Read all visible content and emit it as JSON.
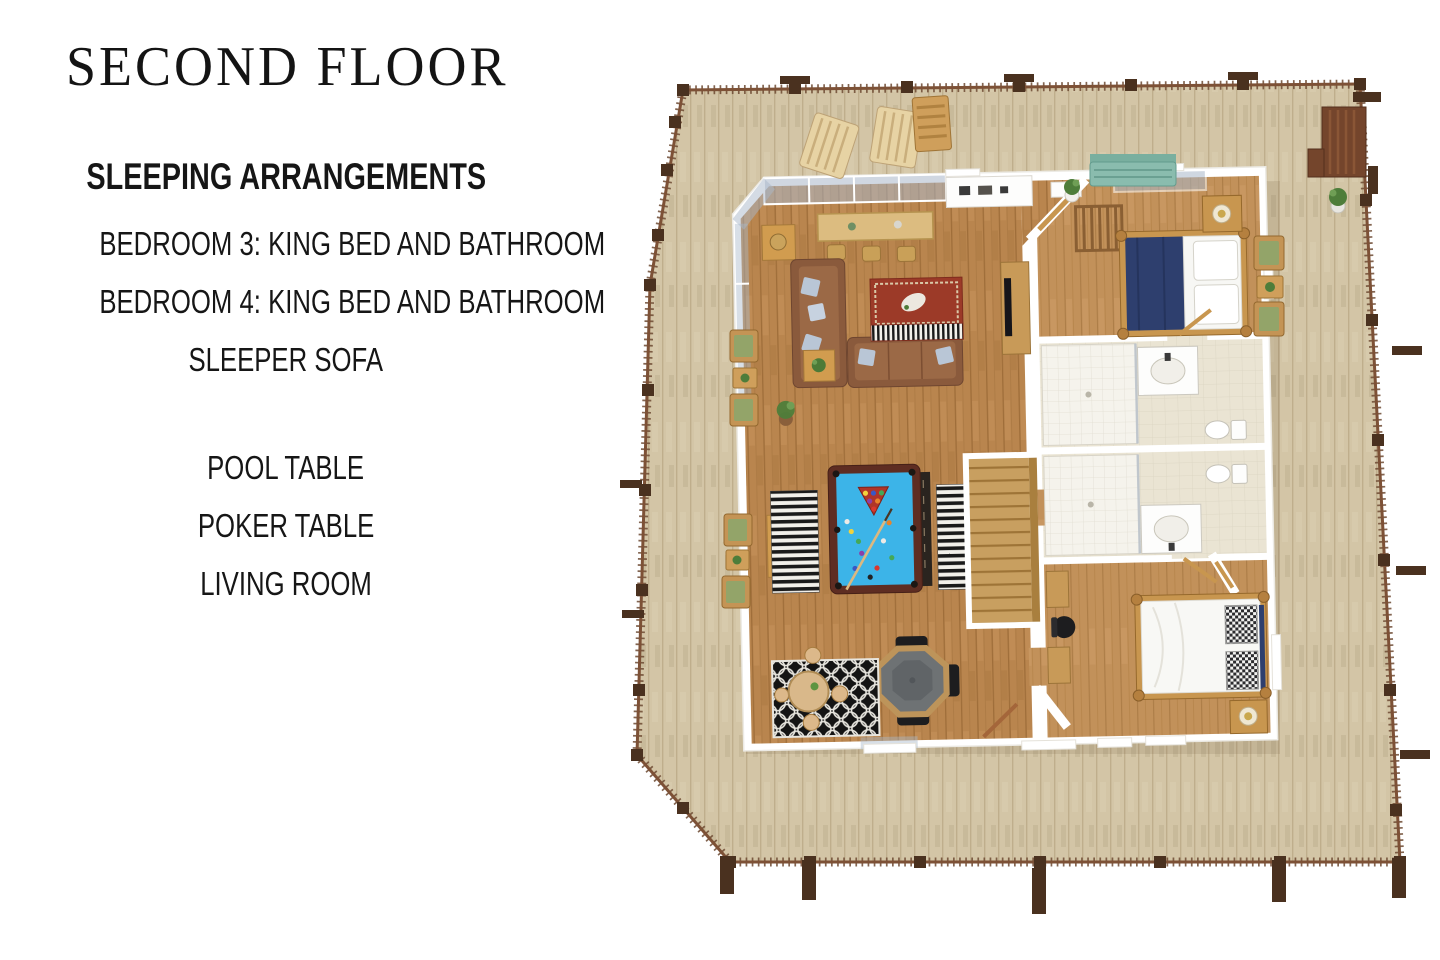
{
  "panel": {
    "title": "SECOND FLOOR",
    "sleeping": {
      "heading": "SLEEPING ARRANGEMENTS",
      "items": [
        "BEDROOM 3: KING BED AND BATHROOM",
        "BEDROOM 4: KING BED AND BATHROOM",
        "SLEEPER SOFA"
      ]
    },
    "features": [
      "POOL TABLE",
      "POKER TABLE",
      "LIVING ROOM"
    ]
  },
  "floorplan": {
    "rooms": [
      "deck",
      "living-room",
      "bedroom-3",
      "bathroom-3",
      "bathroom-4",
      "bedroom-4",
      "stairs"
    ],
    "furniture": [
      "dining-table",
      "sectional-sofa",
      "sleeper-sofa",
      "area-rug",
      "pool-table",
      "poker-table",
      "round-table",
      "king-bed",
      "nightstand",
      "tv-console",
      "desk",
      "shower",
      "vanity-sink",
      "toilet",
      "deck-chairs",
      "porch-bench"
    ],
    "palette": {
      "deck": "#d3c5a6",
      "deck_line": "#bfae8c",
      "rail": "#6d4a32",
      "post": "#4a311f",
      "wall": "#ffffff",
      "oak": "#b9854e",
      "oak_light": "#c2915a",
      "tile": "#eae4d3",
      "shower": "#f5f3ec",
      "pool_felt": "#3cb4e8",
      "pool_rim": "#5e2d22",
      "navy_bed": "#2e3f6e",
      "sofa_brown": "#8a5a3c",
      "rug_red": "#9c3a28",
      "rug_black": "#141414",
      "teal_bench": "#8abcae",
      "wood_furniture": "#cf9f5b",
      "chair_black": "#1d1d1f",
      "plant_green": "#4e7d3a",
      "cushion_green": "#93a469",
      "glass": "#a9b7c9",
      "stairs": "#c89f60",
      "text": "#161616"
    }
  }
}
